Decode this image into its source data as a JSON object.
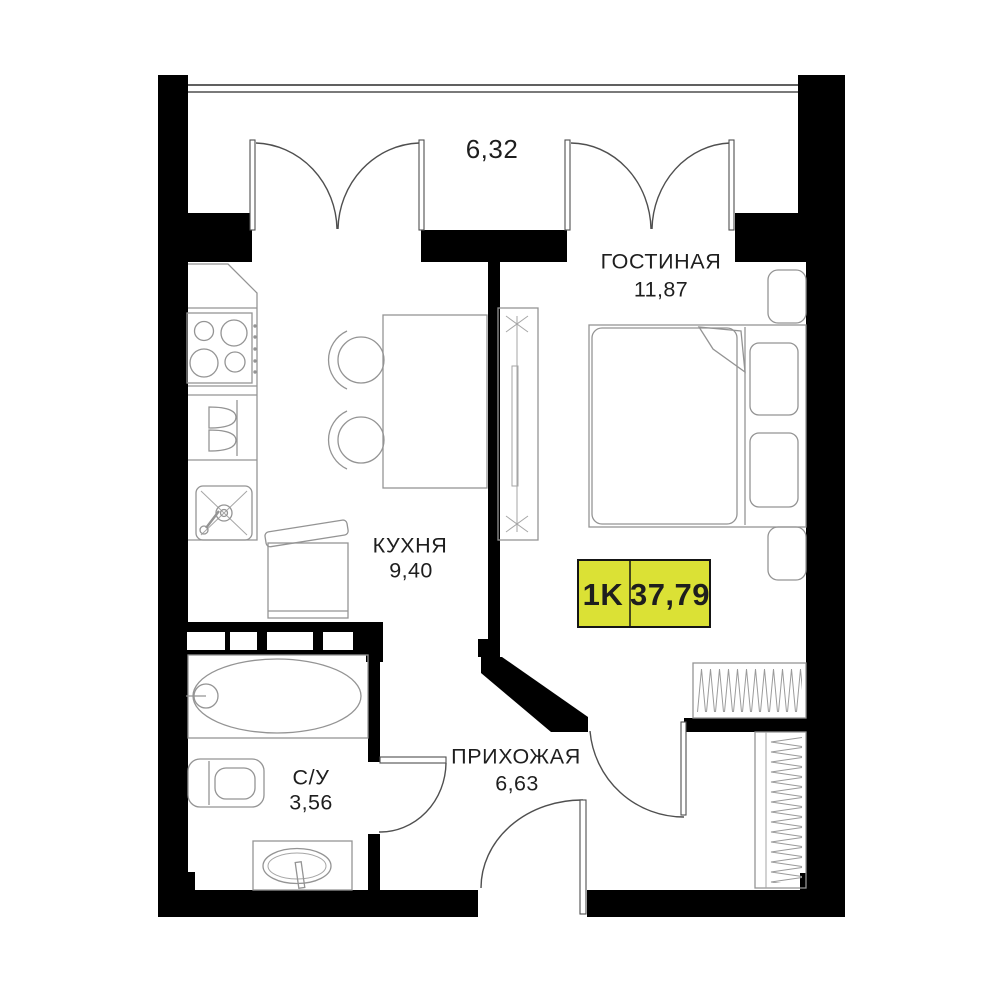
{
  "plan_title": "1K apartment floor plan",
  "badge": {
    "type_label": "1K",
    "area_value": "37,79"
  },
  "balcony": {
    "area_value": "6,32"
  },
  "rooms": {
    "living": {
      "name": "ГОСТИНАЯ",
      "area": "11,87"
    },
    "kitchen": {
      "name": "КУХНЯ",
      "area": "9,40"
    },
    "hall": {
      "name": "ПРИХОЖАЯ",
      "area": "6,63"
    },
    "bath": {
      "name": "С/У",
      "area": "3,56"
    }
  },
  "colors": {
    "wall": "#000000",
    "background": "#ffffff",
    "furniture_line": "#949494",
    "badge_fill": "#dbe135",
    "badge_border": "#151515",
    "text": "#1e1e1e"
  }
}
